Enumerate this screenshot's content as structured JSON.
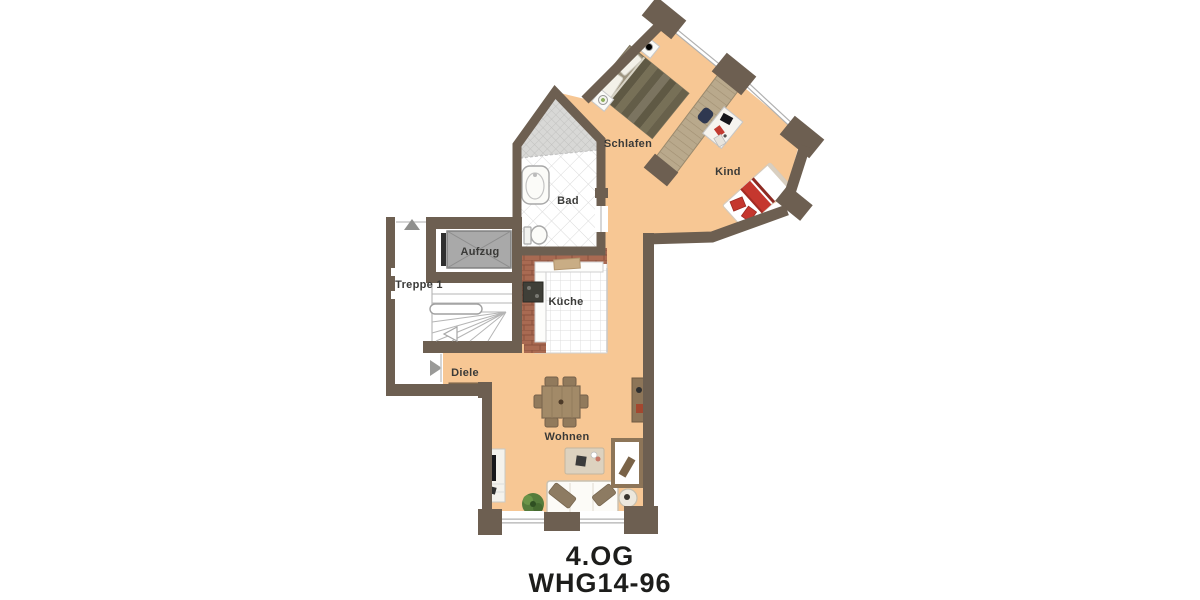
{
  "title": {
    "floor": "4.OG",
    "unit": "WHG14-96"
  },
  "rooms": {
    "schlafen": {
      "label": "Schlafen"
    },
    "kind": {
      "label": "Kind"
    },
    "bad": {
      "label": "Bad"
    },
    "aufzug": {
      "label": "Aufzug"
    },
    "treppe1": {
      "label": "Treppe 1"
    },
    "kueche": {
      "label": "Küche"
    },
    "diele": {
      "label": "Diele"
    },
    "wohnen": {
      "label": "Wohnen"
    }
  },
  "indicators": {
    "entrance_arrow_direction": "right",
    "stairwell_up_arrow_direction": "up",
    "stair_run_arrow_direction": "down-left"
  },
  "colors": {
    "wall": "#6d5f51",
    "floor": "#f7c794",
    "exterior": "#ffffff",
    "elevator_fill": "#a9a9a9",
    "wood_furniture": "#8d7558",
    "wardrobe_wood": "#b9a98c",
    "bed_olive_dark": "#5f5944",
    "bed_olive_light": "#7b7460",
    "accent_red": "#c5372e",
    "tile_line": "#d9d9d9",
    "brick": "#a96a52",
    "label_text": "#3a3a38",
    "title_text": "#1d1d1b"
  }
}
